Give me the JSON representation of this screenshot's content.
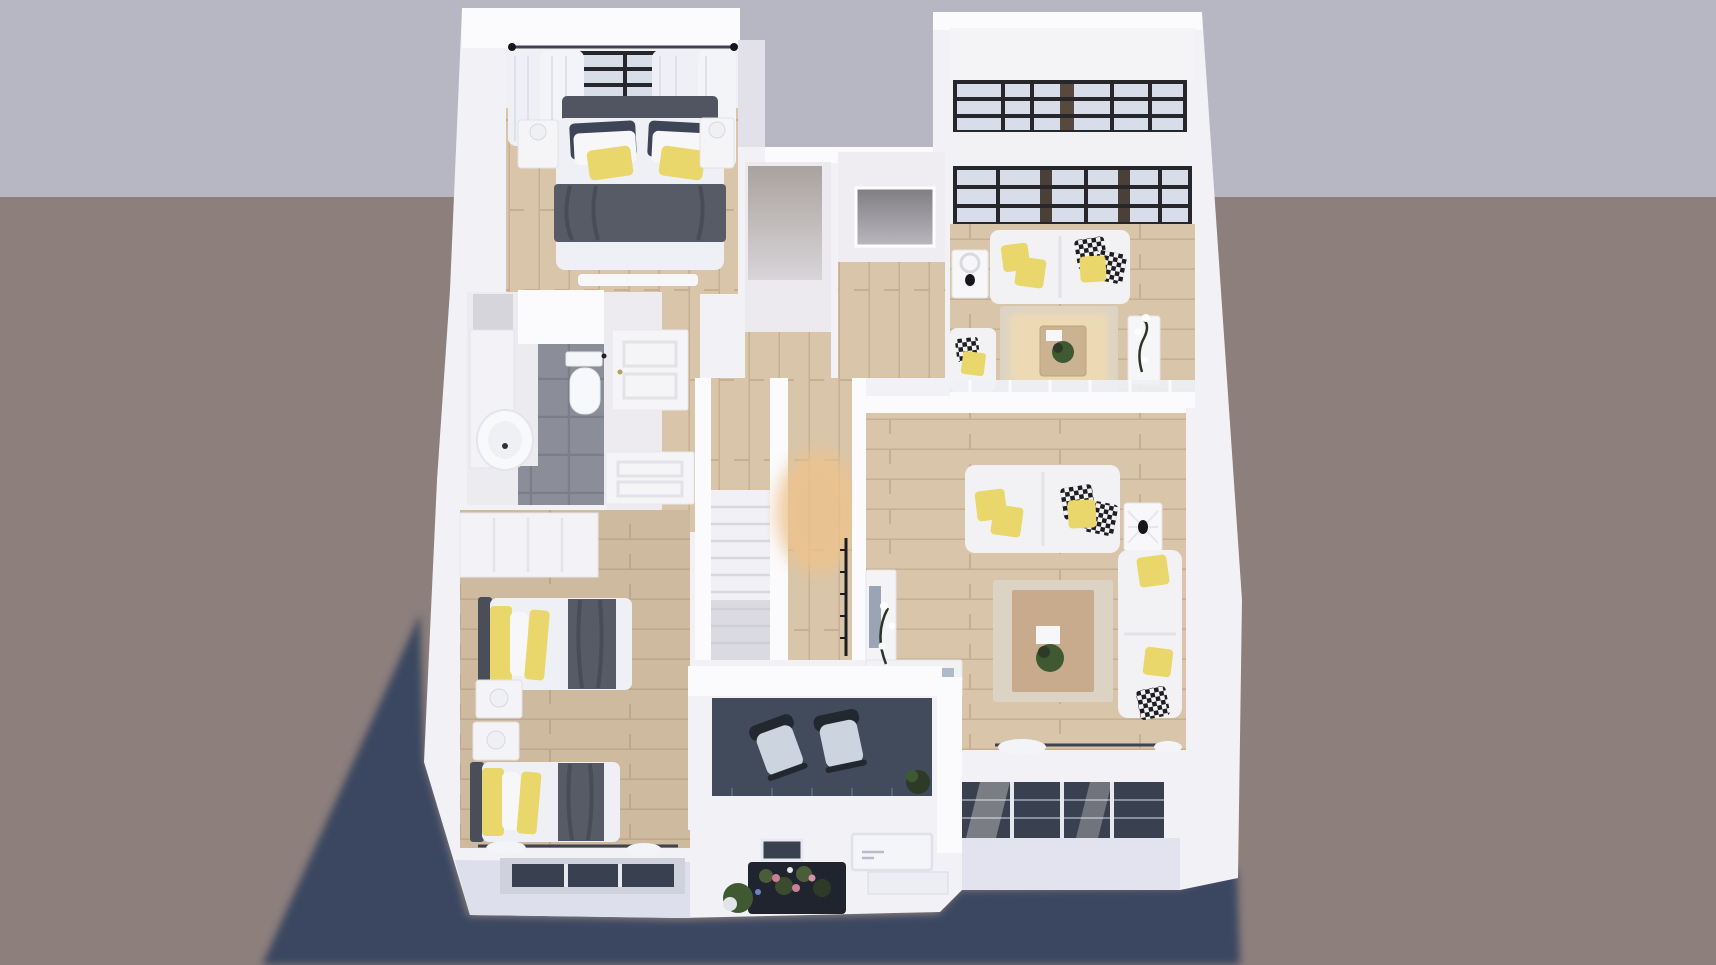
{
  "scene": {
    "type": "3d-floorplan-render",
    "view": "isometric top-down dollhouse render, single storey",
    "background": {
      "upper": "#b7b6c3",
      "lower": "#8d7f7c"
    },
    "rooms": [
      {
        "id": "master-bedroom",
        "label": "Master bedroom",
        "floor": "light wood planks",
        "furniture": [
          "double bed with white duvet",
          "dark gray headboard",
          "navy pillows",
          "yellow accent pillows",
          "gray throw blanket",
          "two white nightstands with lamps",
          "white curtains",
          "black framed window",
          "curtain rod",
          "foot bench"
        ]
      },
      {
        "id": "walk-in-closet",
        "label": "Walk-in closet",
        "floor": "white / wood",
        "furniture": [
          "gray wardrobe slab"
        ]
      },
      {
        "id": "entry-hall",
        "label": "Entry hall",
        "floor": "white / wood",
        "furniture": [
          "gray mirror panel"
        ]
      },
      {
        "id": "lounge",
        "label": "Upper lounge",
        "floor": "warm wood planks",
        "furniture": [
          "white two-seat sofa",
          "yellow cushions",
          "black-white patterned cushions",
          "white fretwork side table with black bird lamp",
          "armchair",
          "beige rug",
          "wood coffee table with plant",
          "white console with flowers",
          "glass balustrade",
          "two bands of black-framed panoramic windows"
        ]
      },
      {
        "id": "bathroom",
        "label": "Bathroom",
        "floor": "dark gray tiles",
        "furniture": [
          "toilet",
          "round white basin",
          "vanity counter",
          "wall niche",
          "partition"
        ]
      },
      {
        "id": "hallway",
        "label": "Hallway",
        "floor": "white / wood",
        "furniture": [
          "two white paneled doors"
        ]
      },
      {
        "id": "staircase",
        "label": "Staircase",
        "floor": "white treads",
        "furniture": [
          "straight stair flight",
          "thin black railing",
          "warm-lit wood landing"
        ]
      },
      {
        "id": "living-room",
        "label": "Living room",
        "floor": "light wood planks",
        "furniture": [
          "two white sofas",
          "yellow cushions",
          "black-white patterned cushions",
          "white fretwork side table with black bird lamp",
          "beige rug",
          "large wood coffee table with plant and white tray",
          "white TV cabinet",
          "flower stems",
          "curtain rod with white curtain"
        ]
      },
      {
        "id": "kids-bedroom",
        "label": "Kids bedroom",
        "floor": "wood planks",
        "furniture": [
          "two single beds with gray blankets",
          "yellow and white pillows",
          "two white nightstands with lamps",
          "built-in closet",
          "curtain rod"
        ]
      },
      {
        "id": "balcony",
        "label": "Balcony",
        "floor": "dark slate",
        "furniture": [
          "two dark armchairs with light cushions",
          "potted plant",
          "white parapet"
        ]
      },
      {
        "id": "facade",
        "label": "Street facade",
        "furniture": [
          "white entry door",
          "dark vent opening",
          "flower planter with pink blooms",
          "green bush",
          "dark glazing band with white mullions",
          "recessed window slots"
        ]
      }
    ],
    "lighting": {
      "cast_shadow": "large soft navy shadow to lower-left",
      "sun": "upper right warm light through stairwell"
    },
    "palette": {
      "bgUpper": "#b7b6c3",
      "bgLower": "#8d7f7c",
      "shadow": "#3b4760",
      "wall": "#f2f1f5",
      "wallBright": "#fbfbfd",
      "wallShade": "#e2e1e9",
      "woodA": "#d8c5aa",
      "woodB": "#c3ab8c",
      "woodHot": "#ecc globalization",
      "woodGlow": "#eec28b",
      "tile": "#8b8e99",
      "tileLine": "#7b7e89",
      "glass": "#d7dee9",
      "glassDark": "#394050",
      "frame": "#26262b",
      "duvet": "#eef0f5",
      "blanket": "#575b66",
      "navy": "#3e4557",
      "yellow": "#e9d76c",
      "sofa": "#f2f2f5",
      "rugOuter": "#ddd3c4",
      "rugInner": "#c8ab8c",
      "balconyFloor": "#414b5c",
      "chairDark": "#232730",
      "chairCushion": "#ccd4e0",
      "plant": "#3f5a33",
      "plantDark": "#2e3a28",
      "grayPanel": "#b4adaa",
      "rod": "#3f434e",
      "doorFill": "#f5f5f8",
      "doorLine": "#e2e2e9",
      "facadeTint": "#dde0ec"
    }
  }
}
